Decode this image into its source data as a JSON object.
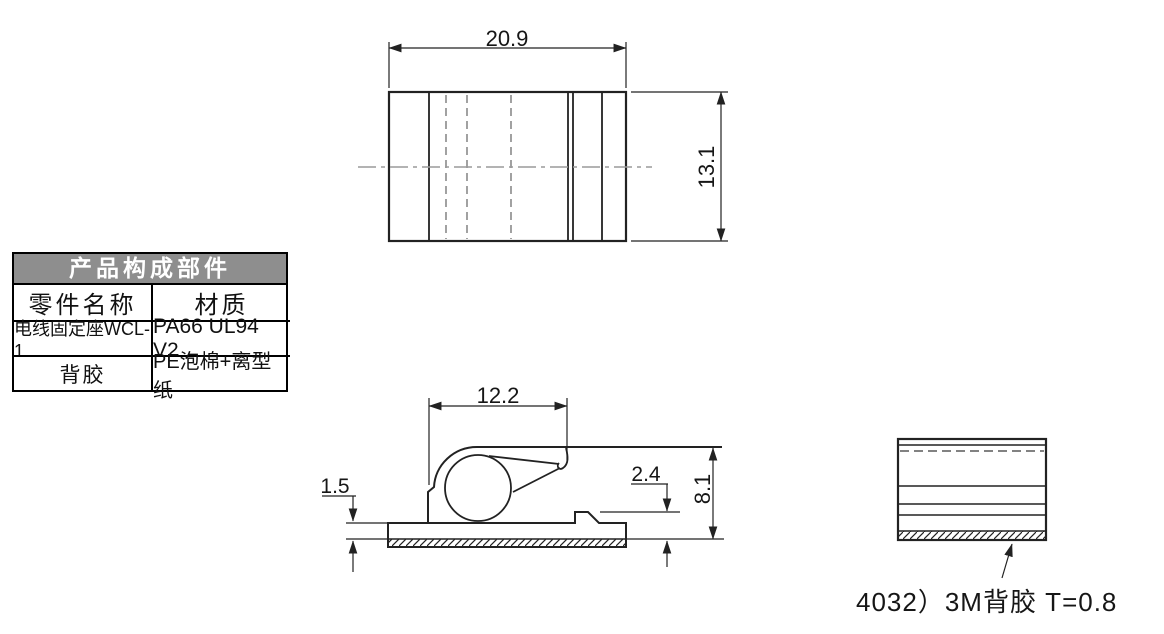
{
  "drawing": {
    "parts_table": {
      "title": "产品构成部件",
      "headers": [
        "零件名称",
        "材质"
      ],
      "rows": [
        [
          "电线固定座WCL-1",
          "PA66 UL94 V2"
        ],
        [
          "背胶",
          "PE泡棉+离型纸"
        ]
      ]
    },
    "top_view": {
      "width_dim": "20.9",
      "height_dim": "13.1"
    },
    "side_view": {
      "clip_width_dim": "12.2",
      "base_thickness_dim": "1.5",
      "step_height_dim": "2.4",
      "overall_height_dim": "8.1"
    },
    "adhesive_view": {
      "note": "4032）3M背胶 T=0.8"
    },
    "colors": {
      "line": "#222222",
      "gray_line": "#9a9a9a",
      "table_header_bg": "#8e8e8e",
      "background": "#ffffff"
    }
  }
}
